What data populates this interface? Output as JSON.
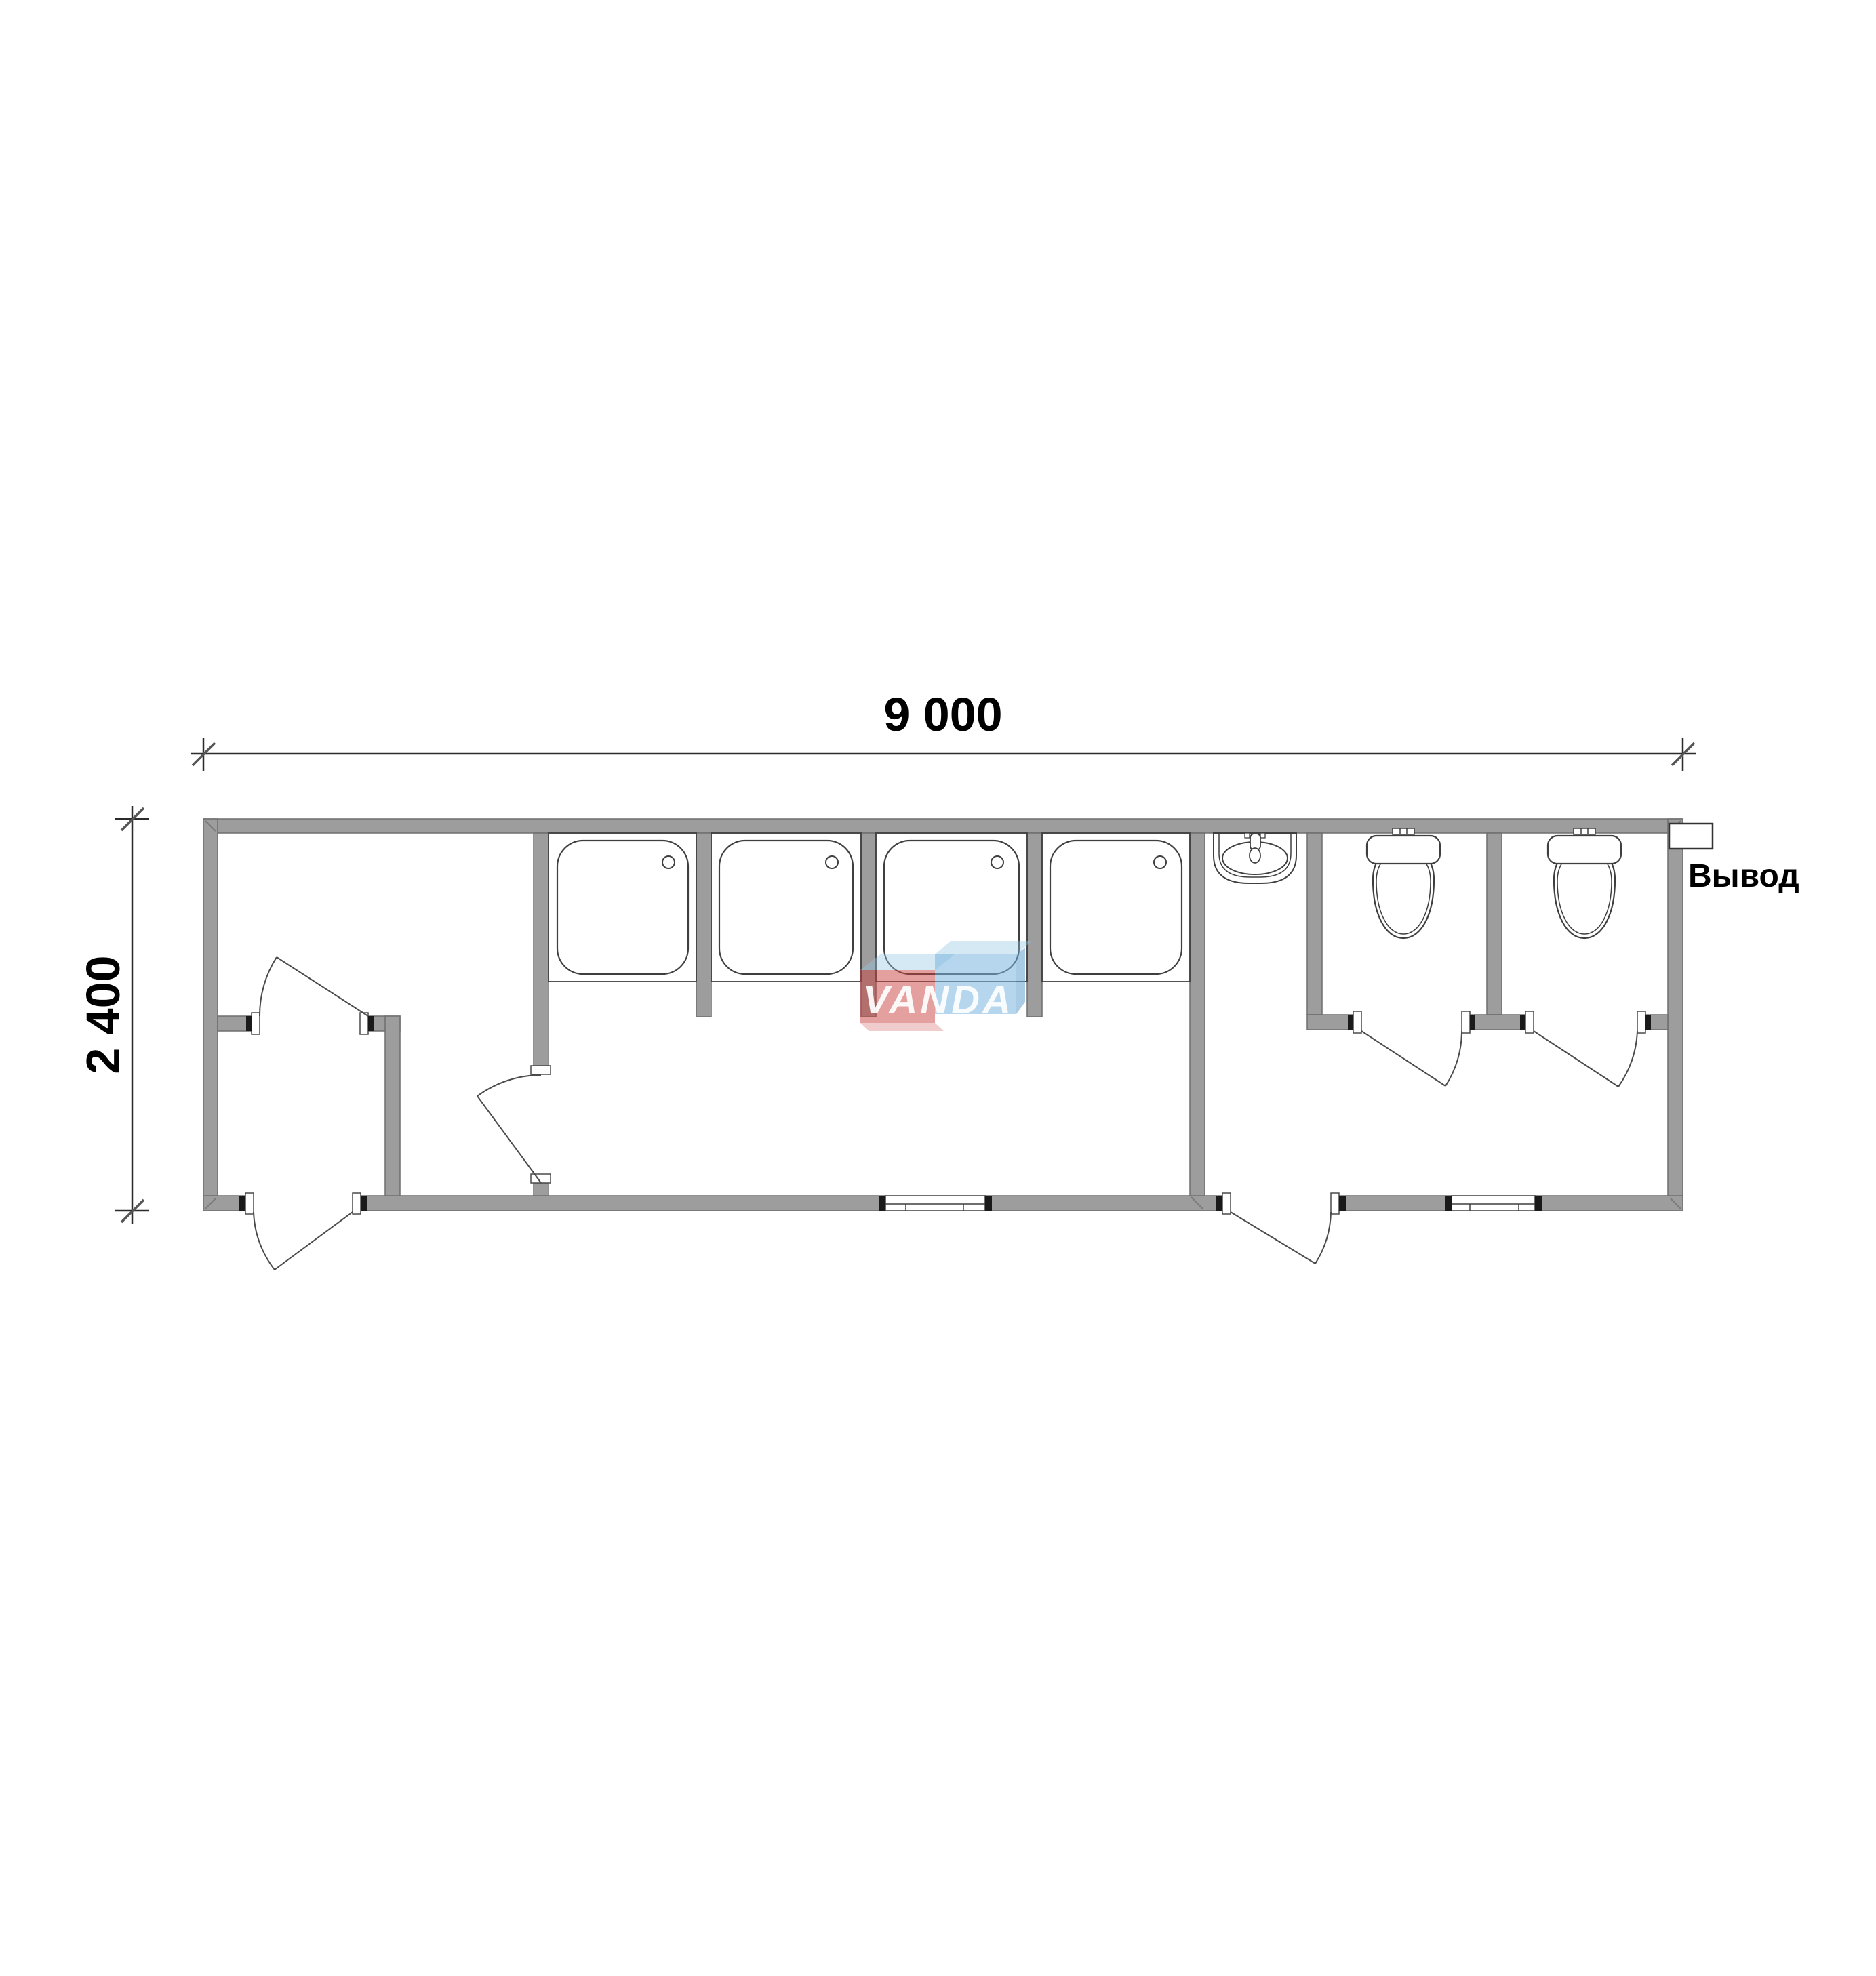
{
  "document": {
    "kind": "architectural floor plan",
    "subject": "sanitary module 9000 x 2400 with showers and toilets",
    "background": "#ffffff"
  },
  "dimensions": {
    "width_label": "9 000",
    "height_label": "2 400"
  },
  "annotations": {
    "outlet_label": "Вывод"
  },
  "watermark": {
    "text": "VANDA",
    "red_block_color": "rgba(202,64,64,0.50)",
    "blue_block_color": "rgba(120,180,220,0.55)",
    "light_face_color": "rgba(150,200,230,0.40)"
  },
  "colors": {
    "wall_fill": "#9d9d9d",
    "wall_stroke": "#6f6f6f",
    "line": "#3f3f3f",
    "text": "#000000"
  },
  "fixtures": {
    "shower_tray_count": 4,
    "toilet_count": 2,
    "sink_count": 1,
    "window_count": 2,
    "door_count": 6,
    "icon_names": [
      "shower-tray-icon",
      "toilet-icon",
      "sink-icon",
      "door-swing-icon",
      "window-icon",
      "outlet-box"
    ]
  }
}
